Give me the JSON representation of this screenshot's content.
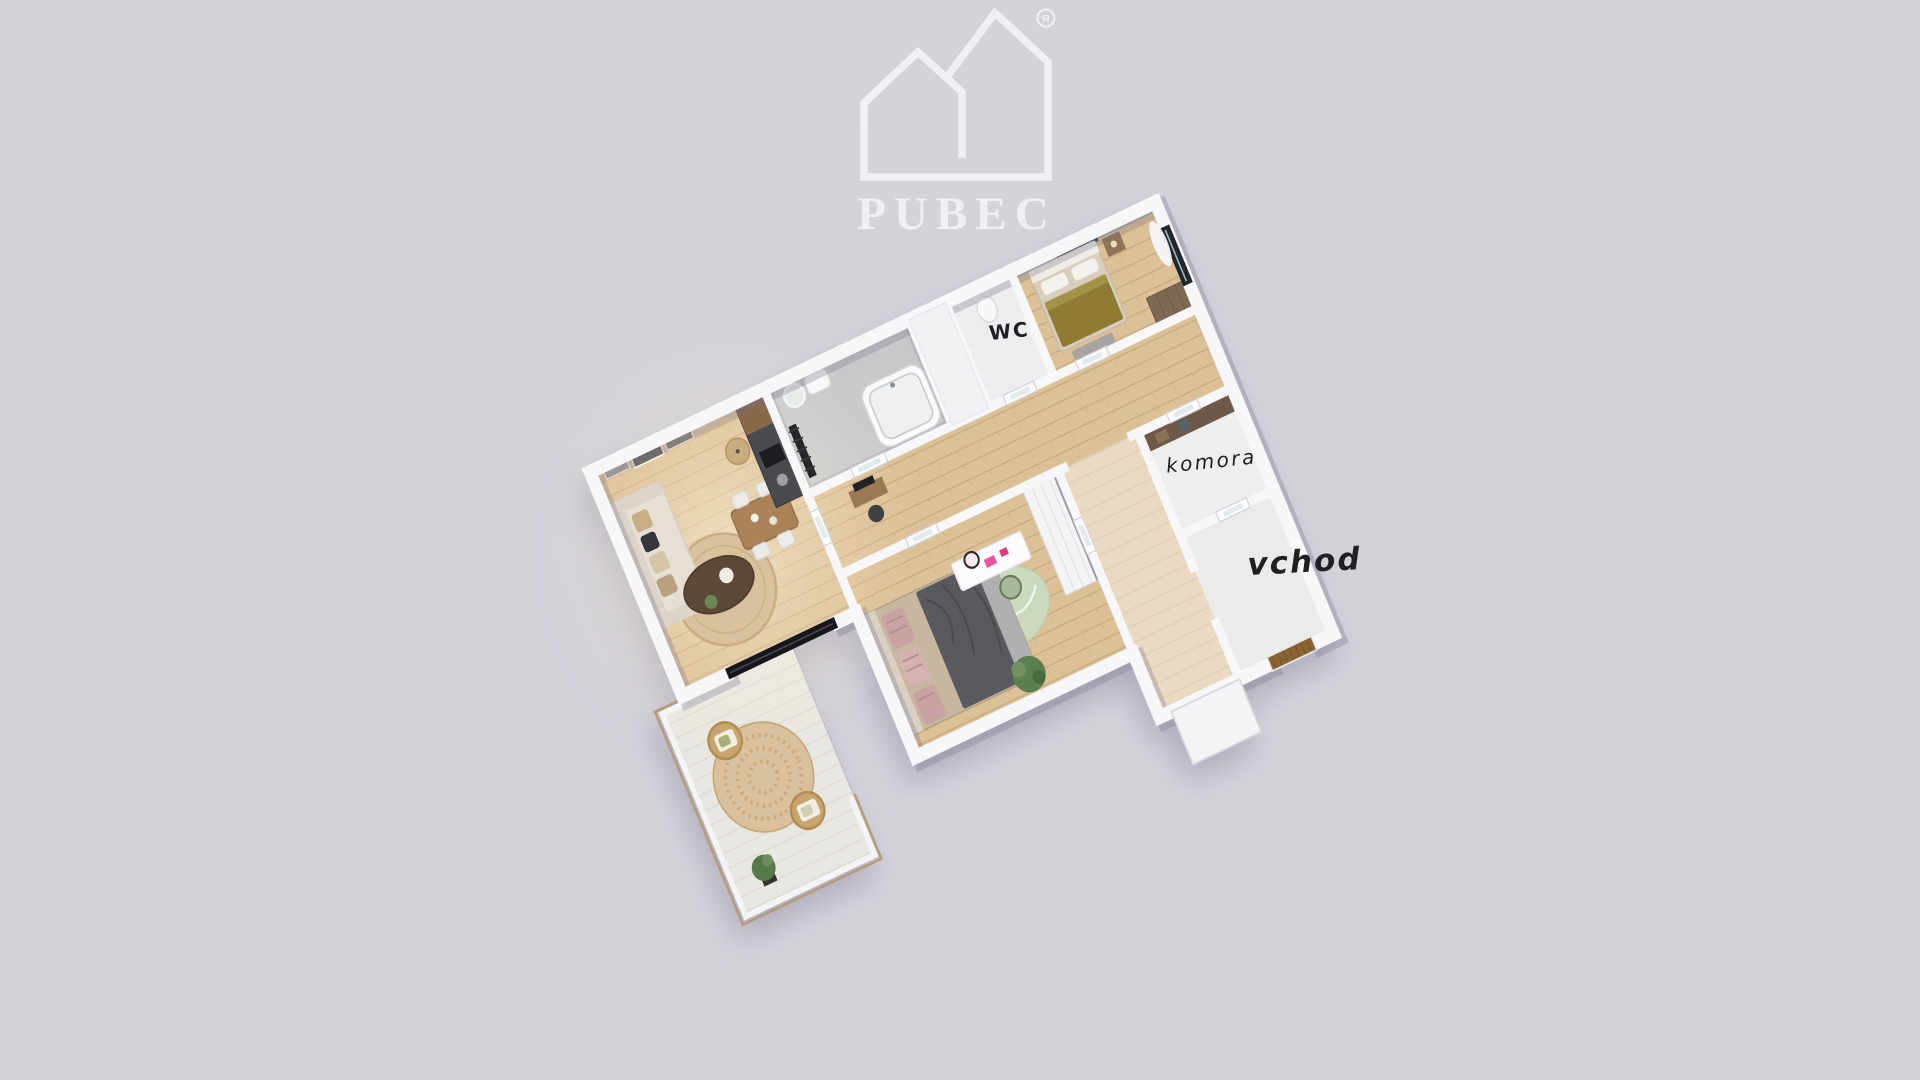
{
  "background_color": "#d5d3da",
  "brand": {
    "name": "PUBEC",
    "registered_mark": "R"
  },
  "plan_labels": {
    "wc": "WC",
    "komora": "komora",
    "vchod": "vchod",
    "label_color": "#1f1f24"
  },
  "palette": {
    "logo": "#f2f1f5",
    "wall": "#f7f7f9",
    "wood_floor": "#dcc096",
    "bathroom_floor": "#c8c9cb",
    "balcony_floor": "#e9e7e1",
    "jute_rug": "#d8c19c",
    "green_rug": "#cbd9bd",
    "olive_blanket": "#8f7c33",
    "dark_blanket": "#595a5e",
    "front_door": "#8a6434",
    "komora_shelf": "#6e5947",
    "sofa": "#e6e0d4",
    "coffee_table": "#5d4937",
    "kitchen_dark": "#4a4b50",
    "rattan": "#c9a56d"
  }
}
